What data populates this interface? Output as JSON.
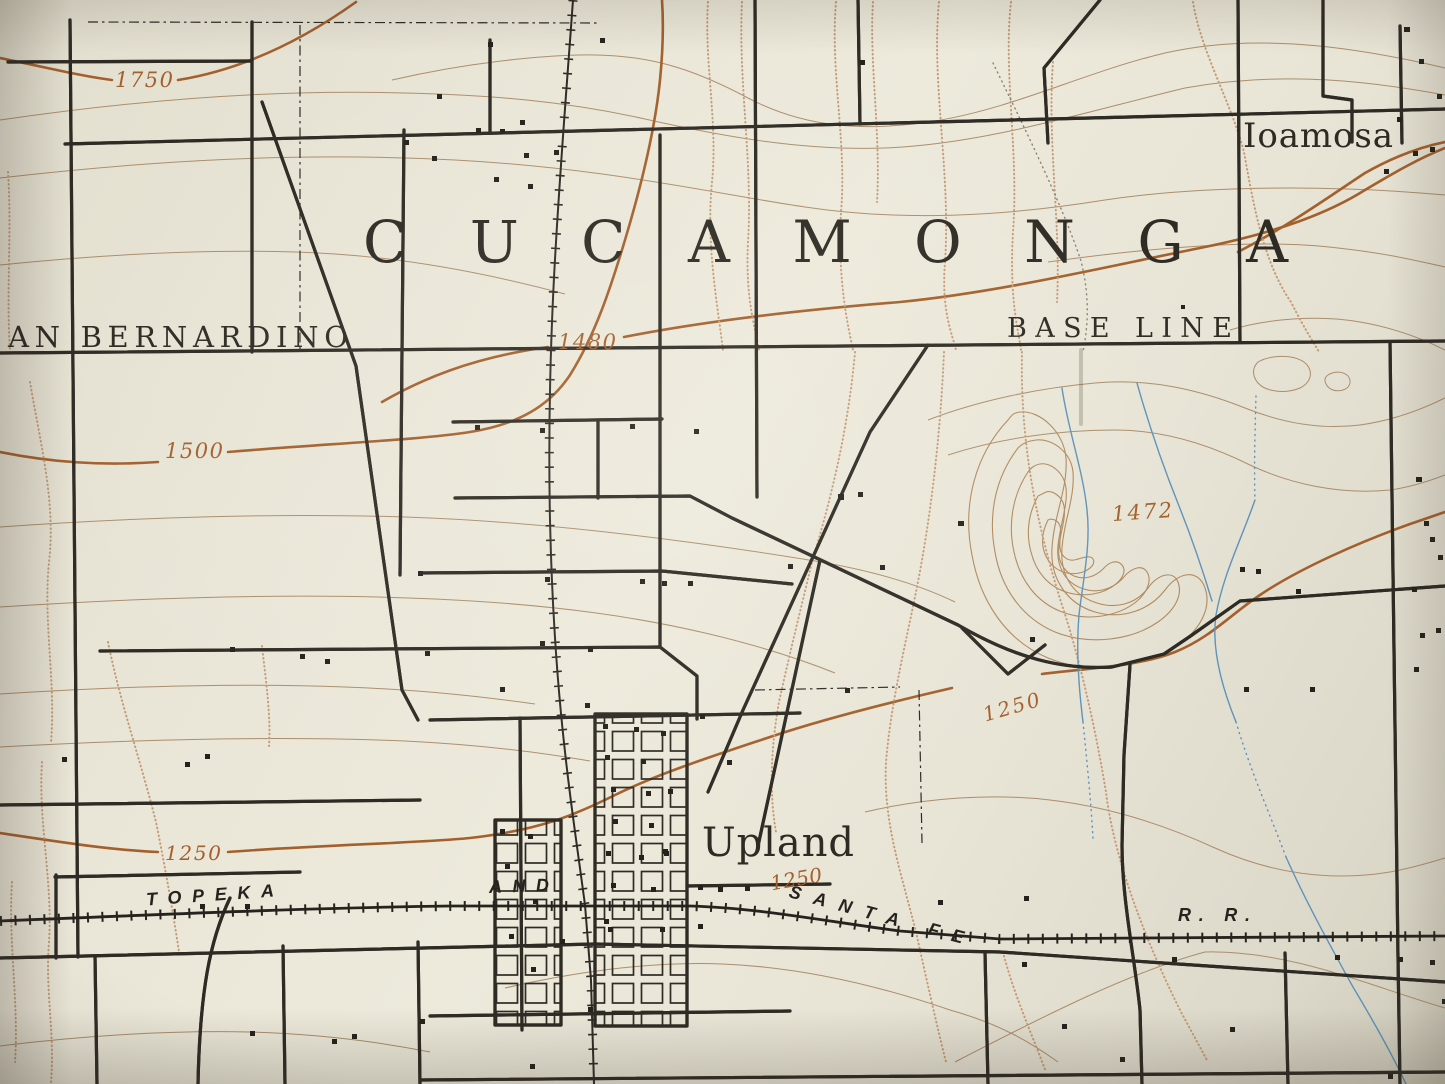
{
  "map": {
    "townships": {
      "cucamonga": "CUCAMONGA",
      "san_bernardino_partial": "AN BERNARDINO"
    },
    "places": {
      "ioamosa": "Ioamosa",
      "upland": "Upland"
    },
    "features": {
      "base_line": "BASE LINE"
    },
    "railroad_labels": {
      "topeka": "TOPEKA",
      "and": "AND",
      "santa_fe": "SANTA FE",
      "rr": "R. R."
    },
    "contour_labels": {
      "c1750": "1750",
      "c1500": "1500",
      "c1480": "1480",
      "c1472": "1472",
      "c1250_west": "1250",
      "c1250_mid": "1250",
      "c1250_upland": "1250"
    },
    "colors": {
      "paper": "#eae6d8",
      "ink": "#2e2a24",
      "index_contour": "#a3602c",
      "thin_contour": "#ac8d6b",
      "wash_dots": "#c59b76",
      "water": "#5e93bb"
    }
  }
}
